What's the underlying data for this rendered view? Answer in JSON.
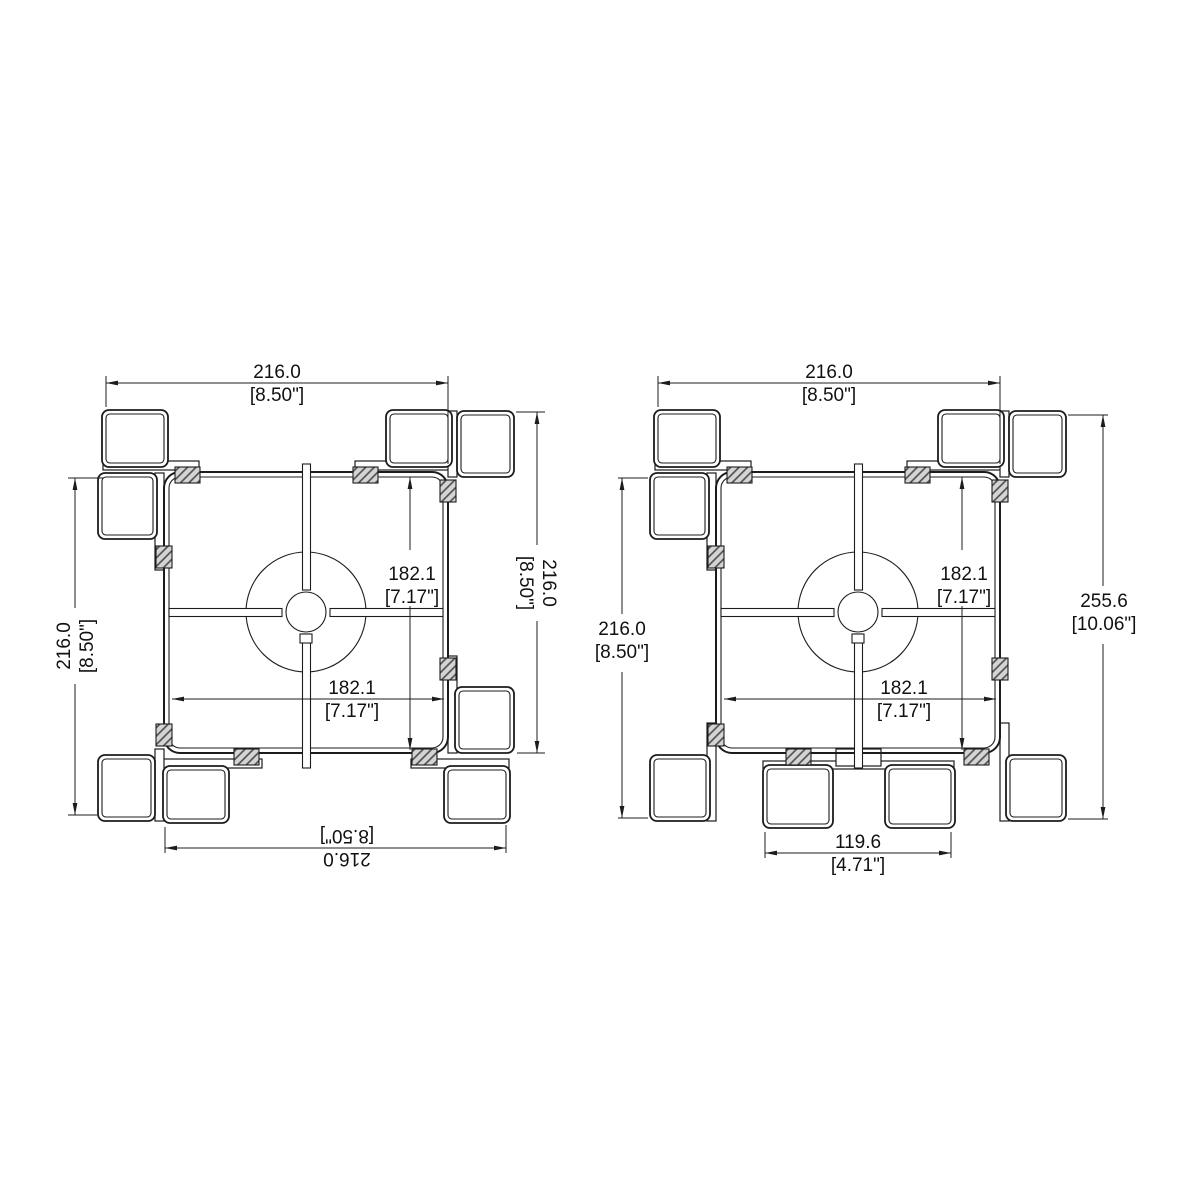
{
  "colors": {
    "background": "#ffffff",
    "line": "#1c1c1c",
    "hatch_fill": "#d4d4d4",
    "hatch_stroke": "#4a4a4a"
  },
  "drawings": [
    {
      "id": "view-1",
      "dims": {
        "top": {
          "mm": "216.0",
          "in": "[8.50\"]"
        },
        "left": {
          "mm": "216.0",
          "in": "[8.50\"]"
        },
        "right": {
          "mm": "216.0",
          "in": "[8.50\"]"
        },
        "bottom": {
          "mm": "216.0",
          "in": "[8.50\"]"
        },
        "inner_vertical": {
          "mm": "182.1",
          "in": "[7.17\"]"
        },
        "inner_horizontal": {
          "mm": "182.1",
          "in": "[7.17\"]"
        }
      }
    },
    {
      "id": "view-2",
      "dims": {
        "top": {
          "mm": "216.0",
          "in": "[8.50\"]"
        },
        "left": {
          "mm": "216.0",
          "in": "[8.50\"]"
        },
        "right": {
          "mm": "255.6",
          "in": "[10.06\"]"
        },
        "bottom": {
          "mm": "119.6",
          "in": "[4.71\"]"
        },
        "inner_vertical": {
          "mm": "182.1",
          "in": "[7.17\"]"
        },
        "inner_horizontal": {
          "mm": "182.1",
          "in": "[7.17\"]"
        }
      }
    }
  ]
}
